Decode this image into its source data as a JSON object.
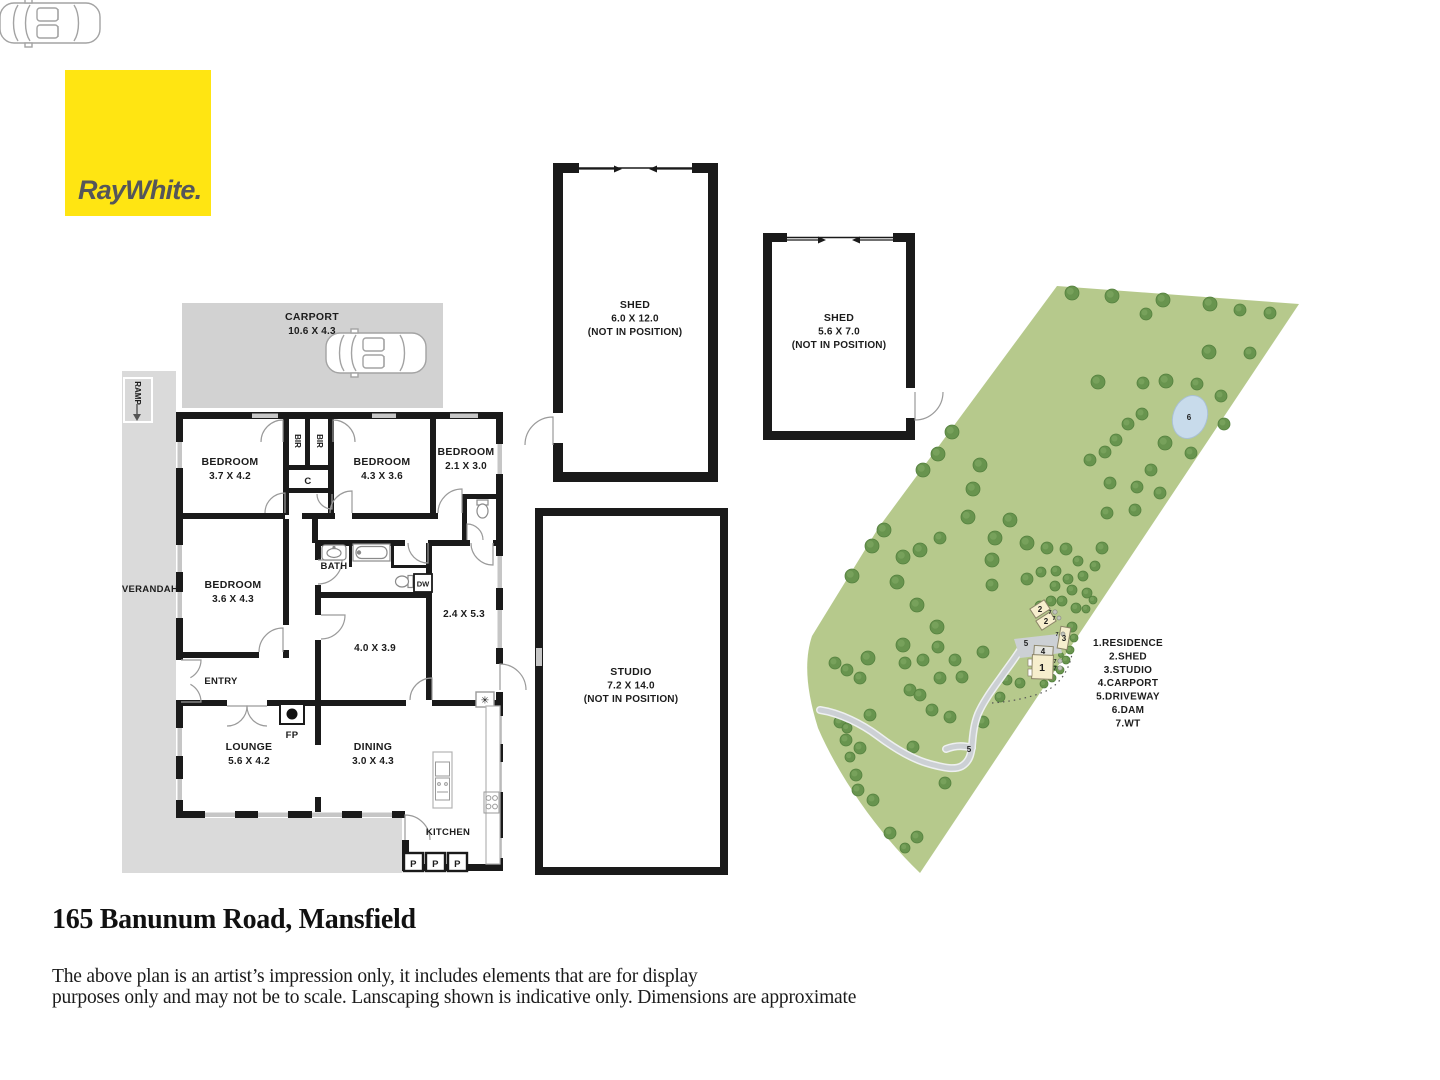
{
  "logo": {
    "brand": "RayWhite."
  },
  "floorplan": {
    "carport": {
      "name": "CARPORT",
      "dims": "10.6 X 4.3"
    },
    "ramp": "RAMP",
    "verandah": "VERANDAH",
    "entry": "ENTRY",
    "kitchen": "KITCHEN",
    "bath": "BATH",
    "c": "C",
    "fp": "FP",
    "dw": "DW",
    "bir": "BIR",
    "pantry": "P",
    "heater_icon": "✳",
    "bedroom1": {
      "name": "BEDROOM",
      "dims": "3.7 X 4.2"
    },
    "bedroom2": {
      "name": "BEDROOM",
      "dims": "4.3 X 3.6"
    },
    "bedroom3": {
      "name": "BEDROOM",
      "dims": "2.1 X 3.0"
    },
    "bedroom4": {
      "name": "BEDROOM",
      "dims": "3.6 X 4.3"
    },
    "room_a": {
      "dims": "4.0 X 3.9"
    },
    "room_b": {
      "dims": "2.4 X 5.3"
    },
    "lounge": {
      "name": "LOUNGE",
      "dims": "5.6 X 4.2"
    },
    "dining": {
      "name": "DINING",
      "dims": "3.0 X 4.3"
    }
  },
  "outbuildings": {
    "shed1": {
      "name": "SHED",
      "dims": "6.0 X 12.0",
      "note": "(NOT IN POSITION)"
    },
    "shed2": {
      "name": "SHED",
      "dims": "5.6 X 7.0",
      "note": "(NOT IN POSITION)"
    },
    "studio": {
      "name": "STUDIO",
      "dims": "7.2 X 14.0",
      "note": "(NOT IN POSITION)"
    }
  },
  "sitemap": {
    "legend": [
      "1.RESIDENCE",
      "2.SHED",
      "3.STUDIO",
      "4.CARPORT",
      "5.DRIVEWAY",
      "6.DAM",
      "7.WT"
    ],
    "markers": {
      "residence": "1",
      "shed": "2",
      "studio": "3",
      "carport": "4",
      "driveway": "5",
      "dam": "6",
      "wt": "7"
    }
  },
  "footer": {
    "address": "165 Banunum Road, Mansfield",
    "disclaimer1": "The above plan is an artist’s impression only, it includes elements that are for display",
    "disclaimer2": "purposes only and may not be to scale. Lanscaping shown is indicative only. Dimensions are approximate"
  },
  "colors": {
    "brand_yellow": "#ffe512",
    "logo_text": "#55565a",
    "wall_black": "#1a1a1a",
    "carport_fill": "#d2d2d2",
    "verandah_fill": "#dadada",
    "land_green": "#b6c98c",
    "tree_green": "#68944e",
    "dam_blue": "#c8dbeb",
    "driveway_gray": "#ccd0d4",
    "building_cream": "#f6eecd"
  }
}
